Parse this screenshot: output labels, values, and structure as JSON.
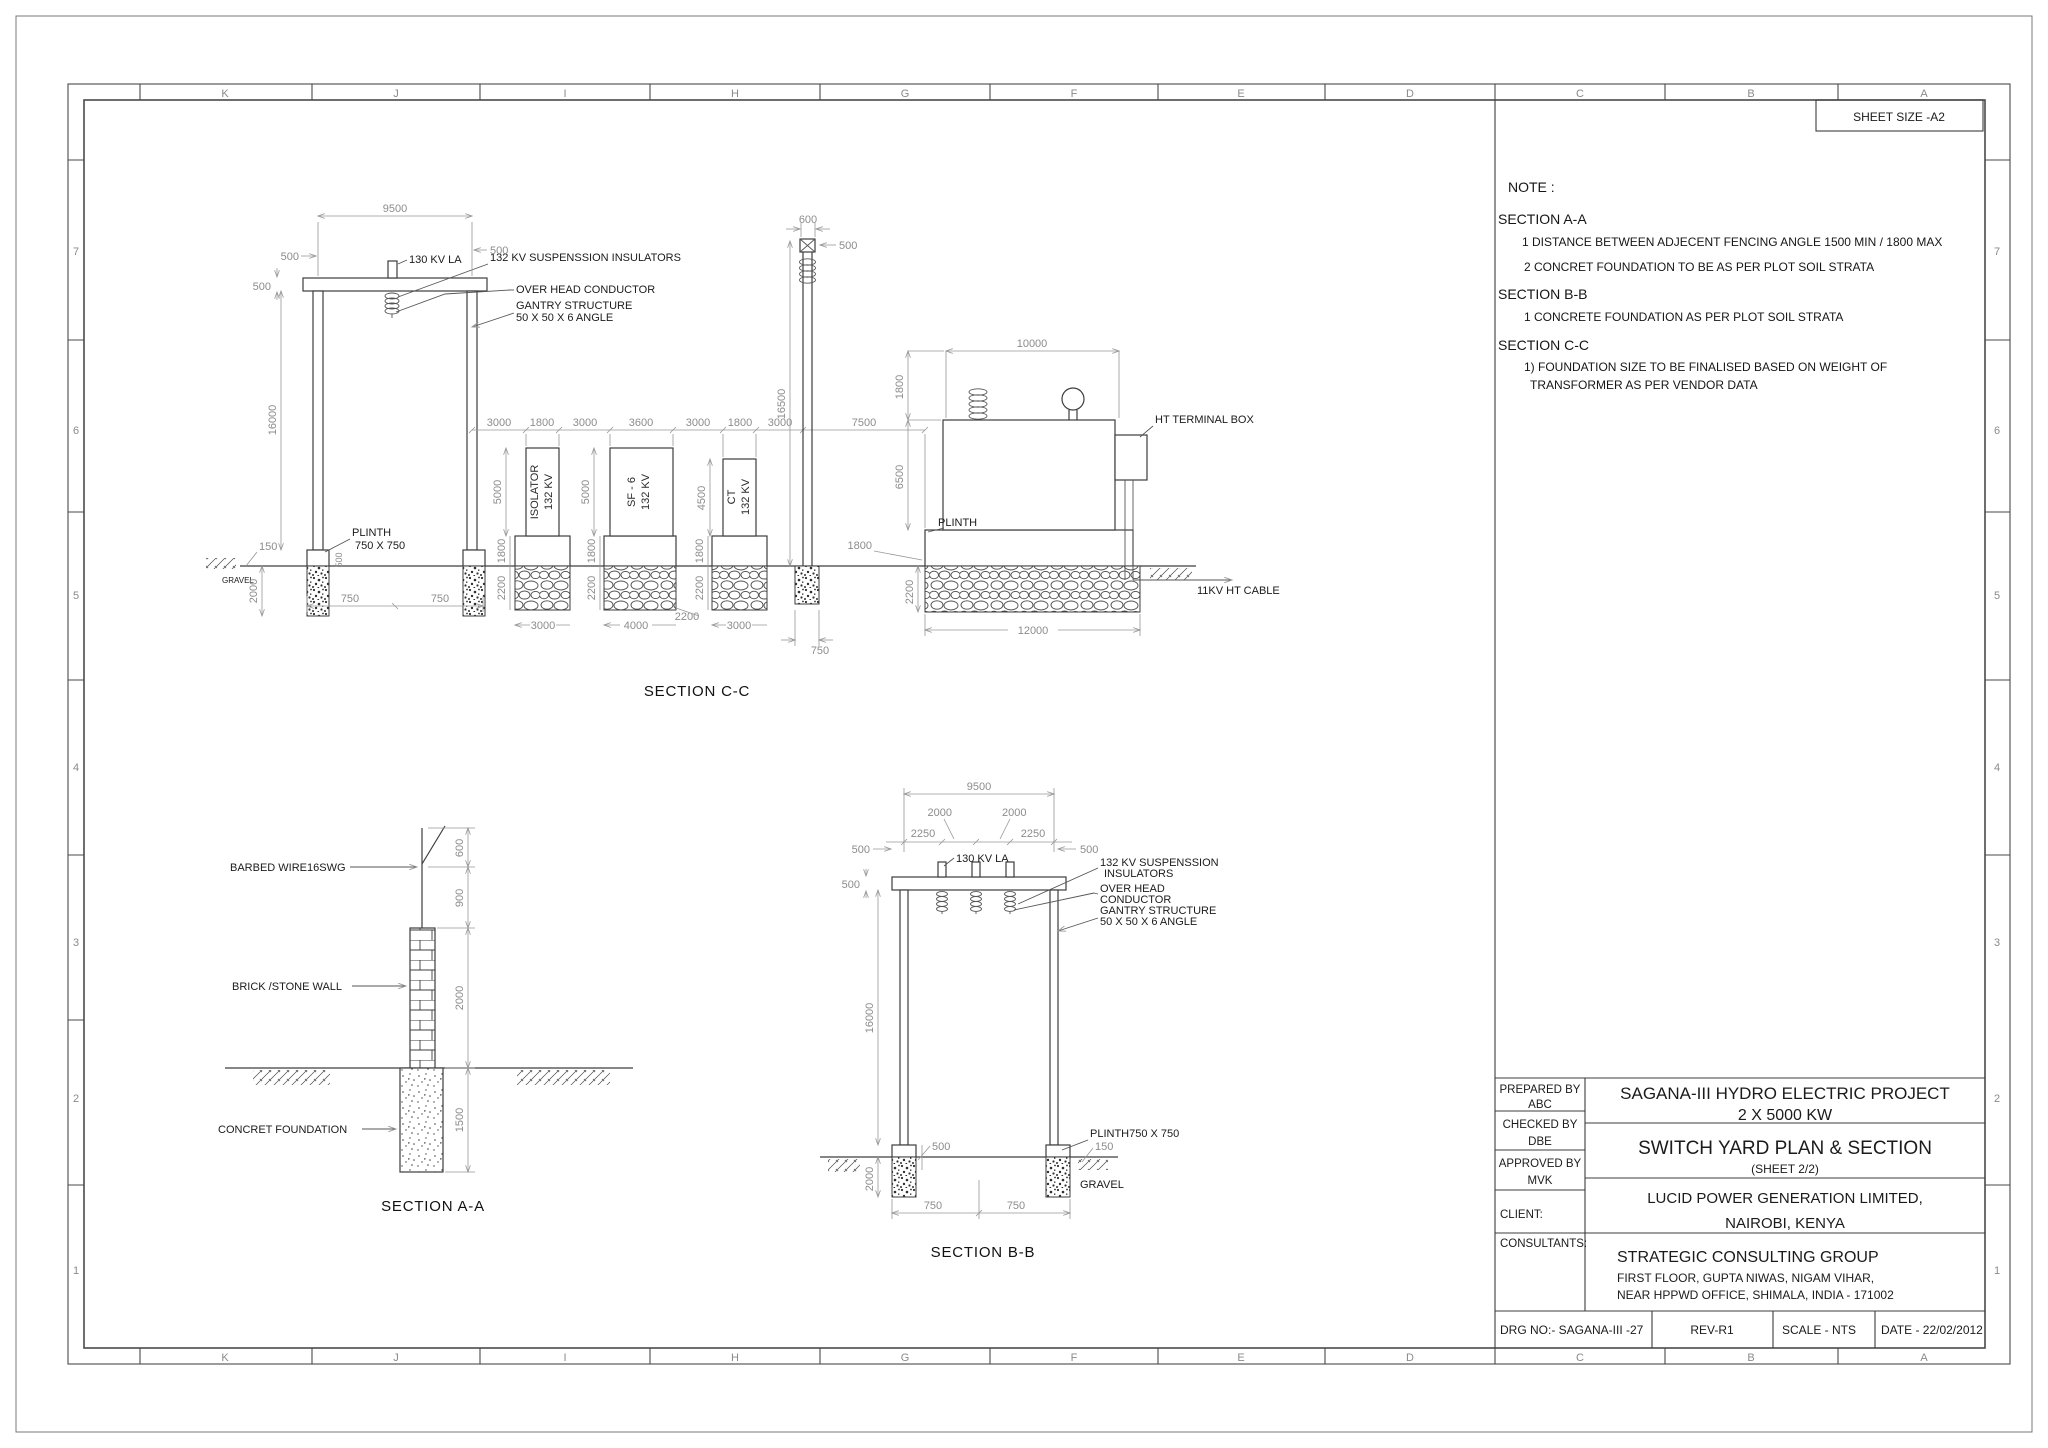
{
  "sheet": {
    "size_label": "SHEET SIZE -A2",
    "grid_letters": [
      "K",
      "J",
      "I",
      "H",
      "G",
      "F",
      "E",
      "D",
      "C",
      "B",
      "A"
    ],
    "grid_numbers": [
      "7",
      "6",
      "5",
      "4",
      "3",
      "2",
      "1"
    ]
  },
  "notes": {
    "title": "NOTE :",
    "a_heading": "SECTION A-A",
    "a_item1": "1 DISTANCE BETWEEN ADJECENT FENCING ANGLE 1500  MIN / 1800  MAX",
    "a_item2": "2 CONCRET FOUNDATION TO BE AS PER PLOT SOIL STRATA",
    "b_heading": "SECTION B-B",
    "b_item1": "1 CONCRETE FOUNDATION AS PER PLOT SOIL STRATA",
    "c_heading": "SECTION C-C",
    "c_item1": "1) FOUNDATION SIZE TO BE FINALISED BASED ON WEIGHT OF",
    "c_item2": "TRANSFORMER AS PER VENDOR DATA"
  },
  "tb": {
    "prepared_label": "PREPARED BY",
    "prepared": "ABC",
    "checked_label": "CHECKED BY",
    "checked": "DBE",
    "approved_label": "APPROVED BY",
    "approved": "MVK",
    "client_label": "CLIENT:",
    "consultants_label": "CONSULTANTS:",
    "project1": "SAGANA-III HYDRO ELECTRIC PROJECT",
    "project2": "2 X 5000 KW",
    "title": "SWITCH YARD PLAN & SECTION",
    "sheet_note": "(SHEET 2/2)",
    "client1": "LUCID POWER GENERATION LIMITED,",
    "client2": "NAIROBI, KENYA",
    "consultant": "STRATEGIC CONSULTING GROUP",
    "addr1": "FIRST FLOOR, GUPTA NIWAS, NIGAM VIHAR,",
    "addr2": "NEAR HPPWD OFFICE, SHIMALA, INDIA - 171002",
    "drg": "DRG NO:- SAGANA-III -27",
    "rev": "REV-R1",
    "scale": "SCALE - NTS",
    "date": "DATE - 22/02/2012"
  },
  "cc": {
    "caption": "SECTION C-C",
    "labels": {
      "la": "130 KV  LA",
      "susp": "132 KV SUSPENSSION INSULATORS",
      "ohc": "OVER HEAD CONDUCTOR",
      "gantry1": "GANTRY STRUCTURE",
      "gantry2": "50 X 50 X 6 ANGLE",
      "plinth1": "PLINTH",
      "plinth2": "750 X 750",
      "gravel": "GRAVEL",
      "iso1": "ISOLATOR",
      "iso2": "132 KV",
      "sf1": "SF - 6",
      "sf2": "132 KV",
      "ct1": "CT",
      "ct2": "132 KV",
      "htbox": "HT TERMINAL BOX",
      "plinth_t": "PLINTH",
      "cable": "11KV HT CABLE"
    },
    "dims": {
      "top9500": "9500",
      "tl500a": "500",
      "tl500b": "500",
      "tr500": "500",
      "h16000": "16000",
      "gravel150": "150",
      "found2000": "2000",
      "plinth500": "500",
      "base750a": "750",
      "base750b": "750",
      "c3000a": "3000",
      "iso1800": "1800",
      "c3000b": "3000",
      "sf3600": "3600",
      "c3000c": "3000",
      "ct1800": "1800",
      "c3000d": "3000",
      "c7500": "7500",
      "iso5000": "5000",
      "sf5000": "5000",
      "ct4500": "4500",
      "p1800a": "1800",
      "p1800b": "1800",
      "p1800c": "1800",
      "f2200a": "2200",
      "f2200b": "2200",
      "f2200c": "2200",
      "fb3000a": "3000",
      "fb4000": "4000",
      "fb2200": "2200",
      "fb3000b": "3000",
      "fb12000": "12000",
      "pole600": "600",
      "pole500": "500",
      "pole16500": "16500",
      "pole750": "750",
      "tr10000": "10000",
      "tr1800": "1800",
      "tr6500": "6500",
      "tp1800": "1800",
      "trf2200": "2200"
    }
  },
  "aa": {
    "caption": "SECTION A-A",
    "labels": {
      "barbed": "BARBED WIRE16SWG",
      "brick": "BRICK /STONE WALL",
      "concrete": "CONCRET FOUNDATION"
    },
    "dims": {
      "d600": "600",
      "d900": "900",
      "d2000": "2000",
      "d1500": "1500"
    }
  },
  "bb": {
    "caption": "SECTION B-B",
    "labels": {
      "la": "130 KV  LA",
      "susp1": "132 KV SUSPENSSION",
      "susp2": "INSULATORS",
      "ohc1": "OVER HEAD",
      "ohc2": "CONDUCTOR",
      "gantry1": "GANTRY STRUCTURE",
      "gantry2": "50 X 50 X 6 ANGLE",
      "plinth": "PLINTH750 X 750",
      "gravel": "GRAVEL"
    },
    "dims": {
      "d9500": "9500",
      "d2000a": "2000",
      "d2000b": "2000",
      "d2250a": "2250",
      "d2250b": "2250",
      "d500a": "500",
      "d500b": "500",
      "d500c": "500",
      "d16000": "16000",
      "p500": "500",
      "g150": "150",
      "f2000": "2000",
      "b750a": "750",
      "b750b": "750"
    }
  }
}
